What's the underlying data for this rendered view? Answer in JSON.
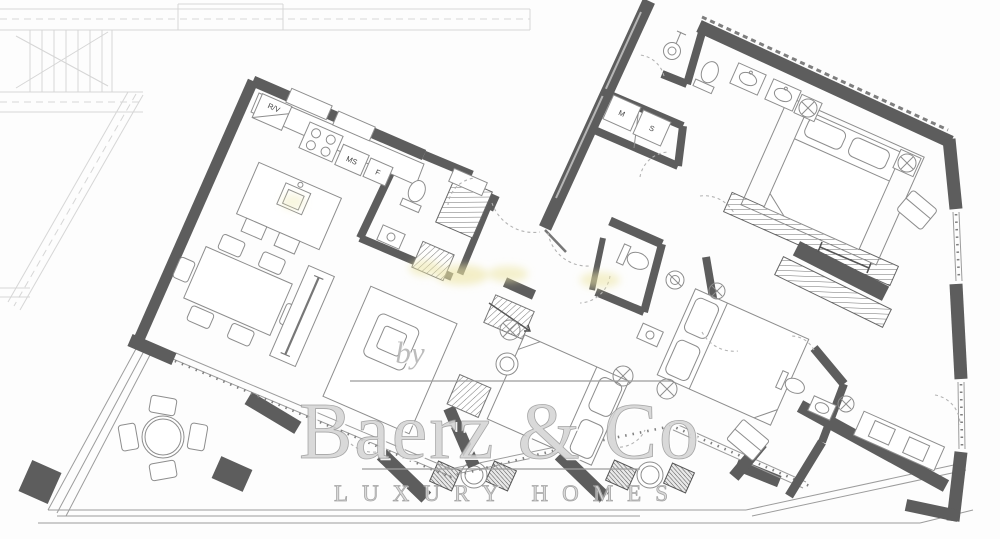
{
  "plan_labels": {
    "rv": "R/V",
    "ms": "MS",
    "f": "F",
    "m": "M",
    "s": "S"
  },
  "watermark": {
    "by": "by",
    "brand": "Baerz & Co",
    "tagline": "LUXURY HOMES"
  },
  "colors": {
    "background": "#fdfdfd",
    "wall": "#5d5d5d",
    "furniture_line": "#8d8d8d",
    "terrace_line": "#9c9c9c",
    "faint": "#d6d6d6",
    "watermark_fill": "#d3d3d3",
    "watermark_stroke": "#979797",
    "highlight": "#ece5a4",
    "label_text": "#3f3f3f"
  }
}
